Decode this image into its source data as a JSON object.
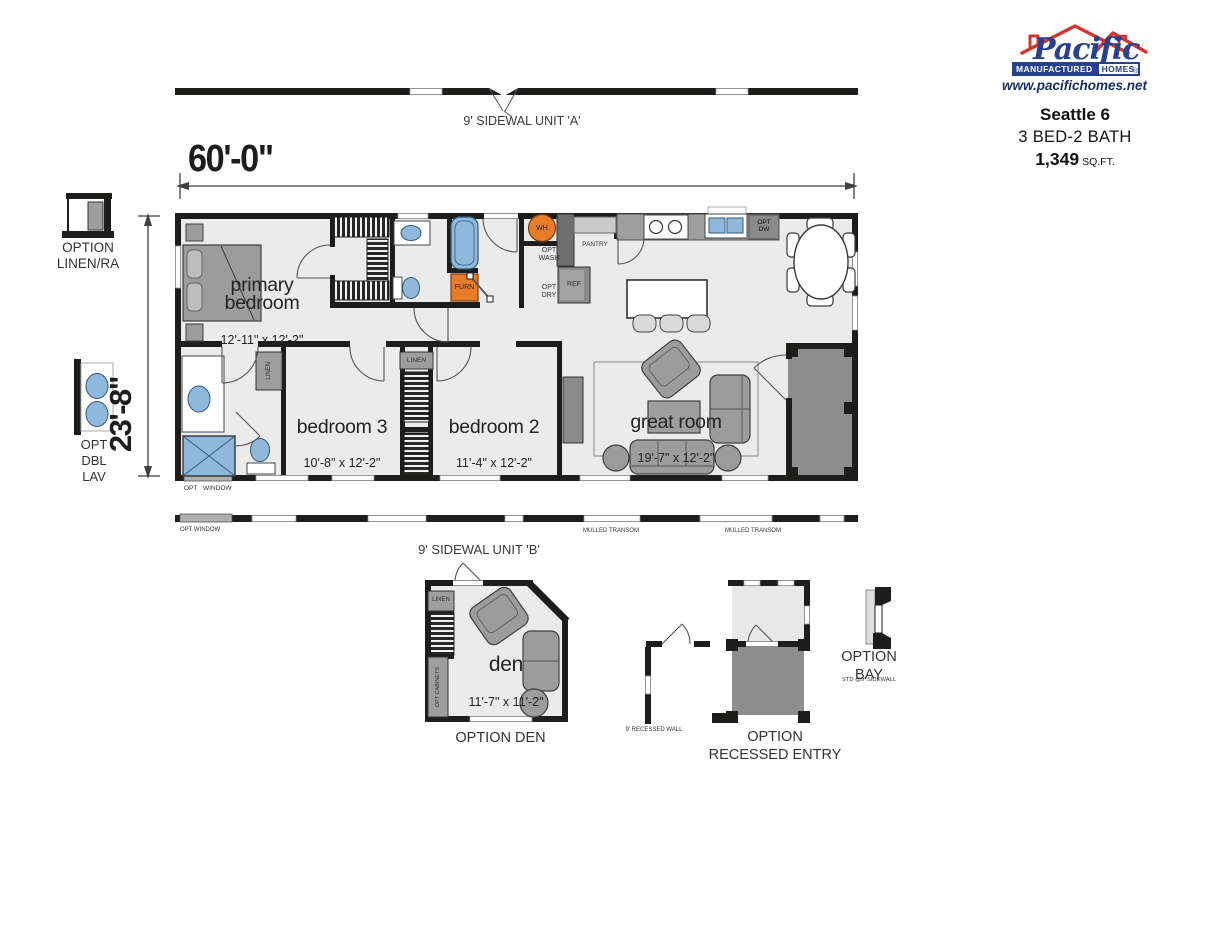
{
  "colors": {
    "wall": "#1d1d1b",
    "room_fill": "#ebebeb",
    "porch_gray": "#8d8d8d",
    "furniture_gray": "#9c9c9c",
    "fixture_blue": "#8fb8dc",
    "appliance_orange": "#e87c28",
    "logo_red": "#d6342e",
    "logo_blue": "#27418f"
  },
  "header": {
    "logo": {
      "brand": "Pacific",
      "bar_left": "MANUFACTURED",
      "bar_right": "HOMES",
      "registered": "®",
      "website": "www.pacifichomes.net"
    },
    "model_name": "Seattle 6",
    "spec": "3 BED-2 BATH",
    "sqft": "1,349",
    "sqft_unit": "SQ.FT."
  },
  "dims": {
    "width": "60'-0\"",
    "height": "23'-8\""
  },
  "elevations": {
    "unit_a": "9' SIDEWAL UNIT 'A'",
    "unit_b": "9' SIDEWAL UNIT 'B'",
    "opt_window": "OPT WINDOW",
    "mulled_1": "MULLED TRANSOM",
    "mulled_2": "MULLED TRANSOM"
  },
  "rooms": {
    "primary": {
      "name": "primary\nbedroom",
      "size": "12'-11\" x 12'-2\""
    },
    "bed3": {
      "name": "bedroom 3",
      "size": "10'-8\" x 12'-2\""
    },
    "bed2": {
      "name": "bedroom 2",
      "size": "11'-4\" x 12'-2\""
    },
    "great": {
      "name": "great room",
      "size": "19'-7\" x 12'-2\""
    }
  },
  "fixtures": {
    "furn": "FURN",
    "wh": "WH",
    "opt_wash": "OPT\nWASH",
    "opt_dry": "OPT\nDRY",
    "pantry": "PANTRY",
    "ref": "REF",
    "opt_dw": "OPT\nDW",
    "linen_bath": "LINEN",
    "linen_hall": "LINEN",
    "opt_window_bath": "OPT WINDOW"
  },
  "side_options": {
    "linen_ra": "OPTION\nLINEN/RA",
    "dbl_lav": "OPT\nDBL\nLAV"
  },
  "bottom_options": {
    "den": {
      "name": "den",
      "size": "11'-7\" x 11'-2\"",
      "caption": "OPTION DEN",
      "linen": "LINEN",
      "cabinets": "OPT CABINETS"
    },
    "recessed_wall": {
      "caption": "9' RECESSED WALL"
    },
    "recessed_entry": {
      "caption": "OPTION\nRECESSED ENTRY"
    },
    "bay": {
      "caption": "OPTION\nBAY",
      "note": "STD @9' SIDEWALL"
    }
  }
}
